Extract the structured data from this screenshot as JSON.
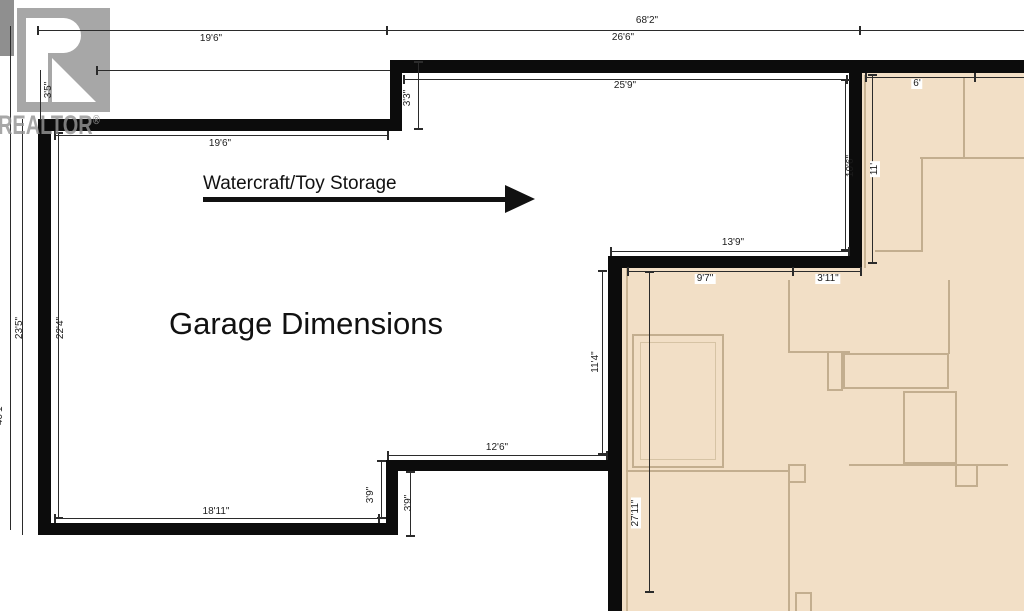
{
  "title": "Garage Dimensions",
  "annotation": {
    "storage_label": "Watercraft/Toy Storage"
  },
  "watermark": {
    "brand": "REALTOR",
    "registered": "®"
  },
  "labels": {
    "overall_width": "68'2\"",
    "top_left_width": "19'6\"",
    "top_right_width": "26'6\"",
    "inner_top_right_width": "25'9\"",
    "storage_inner_width": "19'6\"",
    "jog_top": "3'3\"",
    "top_offset_left": "3'5\"",
    "left_outer_height": "40'1\"",
    "left_height": "23'5\"",
    "left_inner_height": "22'4\"",
    "bottom_width": "18'11\"",
    "lower_jog_left": "3'9\"",
    "lower_jog_right": "3'9\"",
    "lower_step_width": "12'6\"",
    "mid_wall_height": "11'4\"",
    "step_width": "13'9\"",
    "step_inner_left": "9'7\"",
    "step_inner_right": "3'11\"",
    "tan_left_height": "27'11\"",
    "right_wall_height_inner": "10'6\"",
    "right_wall_height_tan": "11'",
    "tan_top_width": "6'"
  },
  "colors": {
    "wall": "#0c0c0c",
    "tan_fill": "#f2dfc6",
    "tan_outline": "#c3ae8f",
    "watermark_gray": "#a7a7a7",
    "text": "#111111"
  }
}
